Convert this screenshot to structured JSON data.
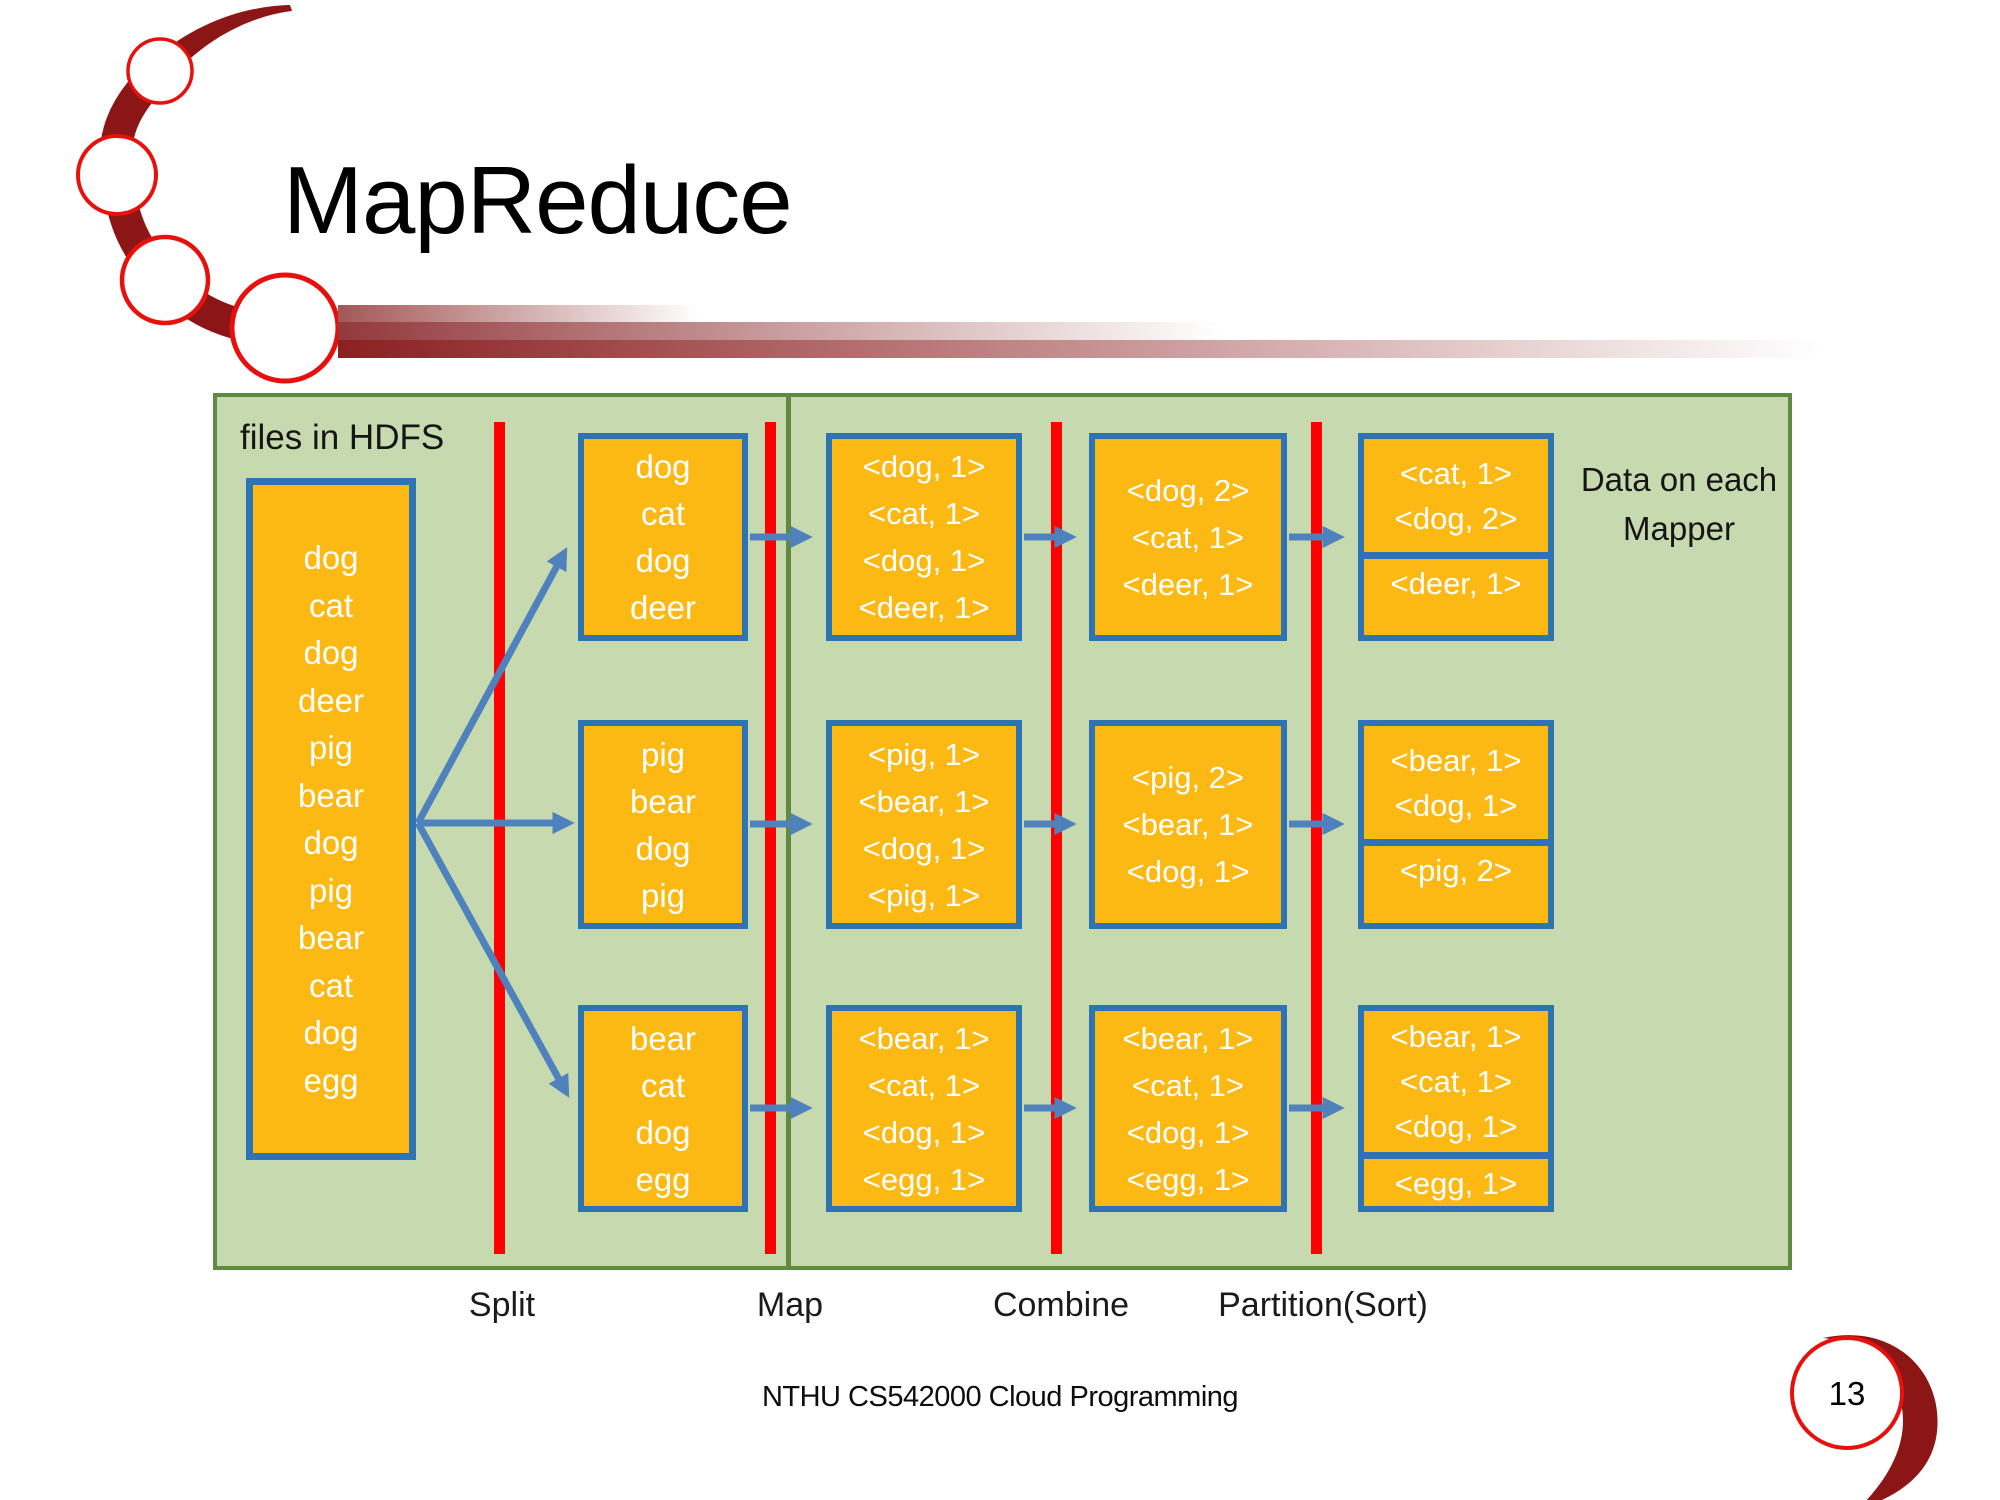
{
  "slide": {
    "title": "MapReduce",
    "footer": "NTHU CS542000 Cloud Programming",
    "page_number": "13"
  },
  "diagram": {
    "hdfs_label": "files in HDFS",
    "mapper_note_line1": "Data on each",
    "mapper_note_line2": "Mapper",
    "input_file": [
      "dog",
      "cat",
      "dog",
      "deer",
      "pig",
      "bear",
      "dog",
      "pig",
      "bear",
      "cat",
      "dog",
      "egg"
    ],
    "rows": [
      {
        "split": [
          "dog",
          "cat",
          "dog",
          "deer"
        ],
        "map": [
          "<dog, 1>",
          "<cat, 1>",
          "<dog, 1>",
          "<deer, 1>"
        ],
        "combine": [
          "<dog, 2>",
          "<cat, 1>",
          "<deer, 1>"
        ],
        "partition_top": [
          "<cat, 1>",
          "<dog, 2>"
        ],
        "partition_bottom": [
          "<deer, 1>"
        ]
      },
      {
        "split": [
          "pig",
          "bear",
          "dog",
          "pig"
        ],
        "map": [
          "<pig, 1>",
          "<bear, 1>",
          "<dog, 1>",
          "<pig, 1>"
        ],
        "combine": [
          "<pig, 2>",
          "<bear, 1>",
          "<dog, 1>"
        ],
        "partition_top": [
          "<bear, 1>",
          "<dog, 1>"
        ],
        "partition_bottom": [
          "<pig, 2>"
        ]
      },
      {
        "split": [
          "bear",
          "cat",
          "dog",
          "egg"
        ],
        "map": [
          "<bear, 1>",
          "<cat, 1>",
          "<dog, 1>",
          "<egg, 1>"
        ],
        "combine": [
          "<bear, 1>",
          "<cat, 1>",
          "<dog, 1>",
          "<egg, 1>"
        ],
        "partition_top": [
          "<bear, 1>",
          "<cat, 1>",
          "<dog, 1>"
        ],
        "partition_bottom": [
          "<egg, 1>"
        ]
      }
    ],
    "stage_labels": [
      "Split",
      "Map",
      "Combine",
      "Partition(Sort)"
    ],
    "colors": {
      "panel_fill": "#c7d9ae",
      "panel_border": "#5f8a3f",
      "box_fill": "#fcb813",
      "box_border": "#2e74b5",
      "arrow": "#4f81bd",
      "stage_line": "#fe0000",
      "accent_dark_red": "#8c1515",
      "accent_red": "#e8100c"
    }
  }
}
